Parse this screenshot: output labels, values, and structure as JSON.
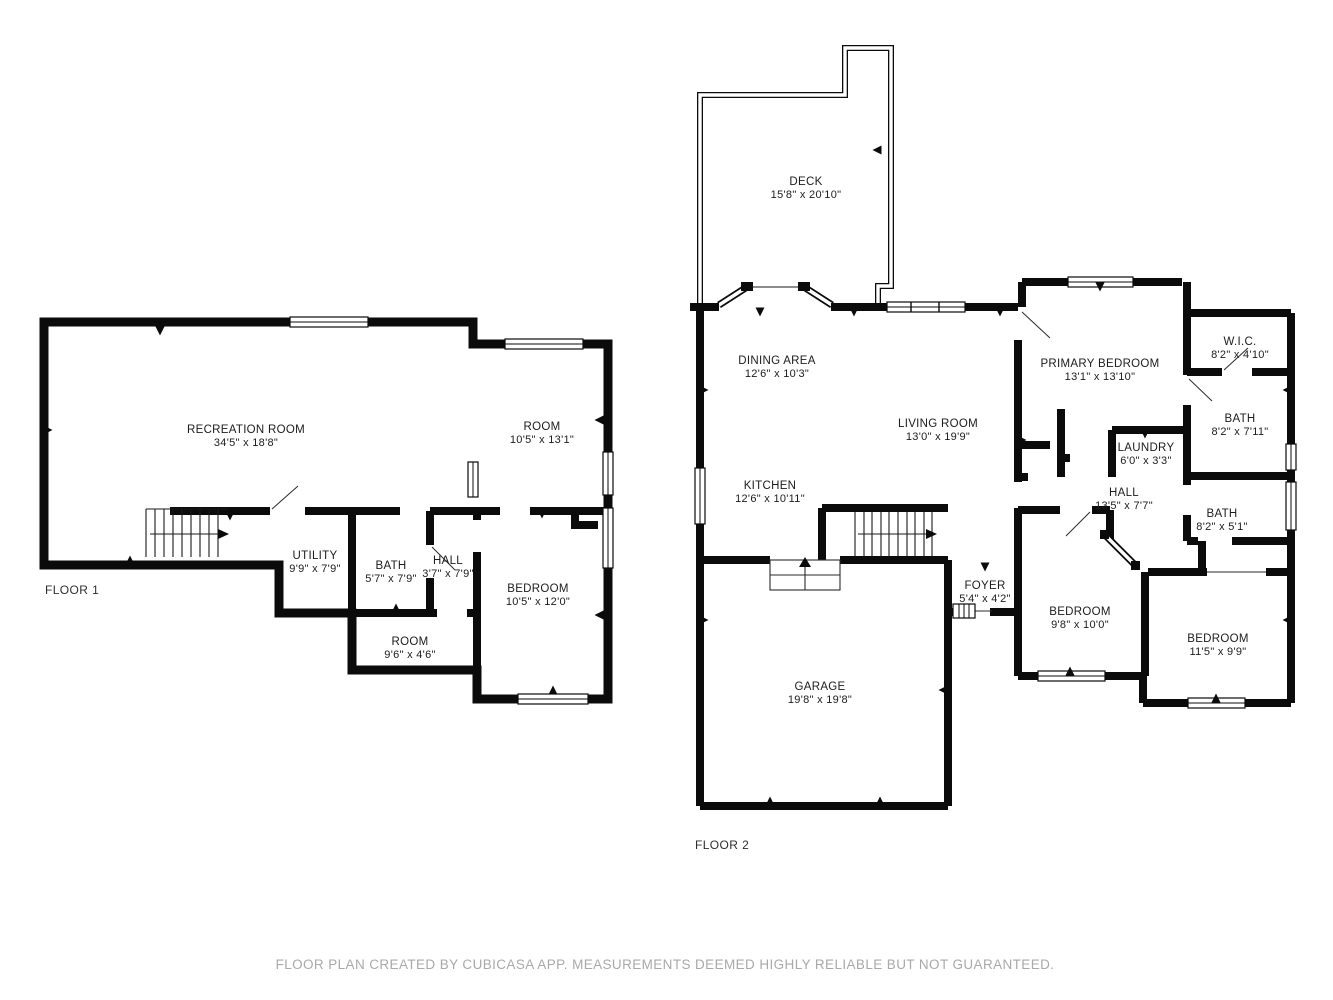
{
  "colors": {
    "wall": "#0b0b0b",
    "label_text": "#1c1c1c",
    "footer_text": "#a9a9a9"
  },
  "floor1": {
    "label": "FLOOR 1",
    "rooms": {
      "recreation": {
        "name": "RECREATION ROOM",
        "dims": "34'5\" x 18'8\""
      },
      "room_upper": {
        "name": "ROOM",
        "dims": "10'5\" x 13'1\""
      },
      "utility": {
        "name": "UTILITY",
        "dims": "9'9\" x 7'9\""
      },
      "bath": {
        "name": "BATH",
        "dims": "5'7\" x 7'9\""
      },
      "hall": {
        "name": "HALL",
        "dims": "3'7\" x 7'9\""
      },
      "bedroom": {
        "name": "BEDROOM",
        "dims": "10'5\" x 12'0\""
      },
      "room_lower": {
        "name": "ROOM",
        "dims": "9'6\" x 4'6\""
      }
    }
  },
  "floor2": {
    "label": "FLOOR 2",
    "rooms": {
      "deck": {
        "name": "DECK",
        "dims": "15'8\" x 20'10\""
      },
      "dining": {
        "name": "DINING AREA",
        "dims": "12'6\" x 10'3\""
      },
      "living": {
        "name": "LIVING ROOM",
        "dims": "13'0\" x 19'9\""
      },
      "kitchen": {
        "name": "KITCHEN",
        "dims": "12'6\" x 10'11\""
      },
      "primary": {
        "name": "PRIMARY BEDROOM",
        "dims": "13'1\" x 13'10\""
      },
      "wic": {
        "name": "W.I.C.",
        "dims": "8'2\" x 4'10\""
      },
      "bath_upper": {
        "name": "BATH",
        "dims": "8'2\" x 7'11\""
      },
      "laundry": {
        "name": "LAUNDRY",
        "dims": "6'0\" x 3'3\""
      },
      "hall": {
        "name": "HALL",
        "dims": "13'5\" x 7'7\""
      },
      "bath_lower": {
        "name": "BATH",
        "dims": "8'2\" x 5'1\""
      },
      "foyer": {
        "name": "FOYER",
        "dims": "5'4\" x 4'2\""
      },
      "bedroom_left": {
        "name": "BEDROOM",
        "dims": "9'8\" x 10'0\""
      },
      "bedroom_right": {
        "name": "BEDROOM",
        "dims": "11'5\" x 9'9\""
      },
      "garage": {
        "name": "GARAGE",
        "dims": "19'8\" x 19'8\""
      }
    }
  },
  "footer": {
    "text": "FLOOR PLAN CREATED BY CUBICASA APP. MEASUREMENTS DEEMED HIGHLY RELIABLE BUT NOT GUARANTEED."
  }
}
